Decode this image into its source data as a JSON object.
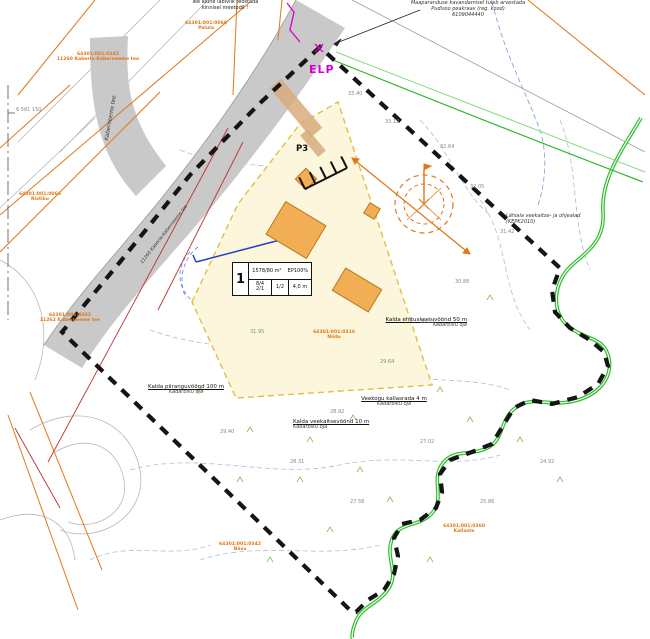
{
  "title": "Detailplaneeringu põhijoonis",
  "colors": {
    "boundary": "#151515",
    "road": "#c9c9c9",
    "plot_fill": "#fcf6dc",
    "plot_border": "#e0c040",
    "cadastral_orange": "#e07818",
    "building_fill": "#f2ae55",
    "river_green": "#2db82d",
    "water_blue": "#2244cc",
    "magenta": "#d400d4",
    "red_line": "#c03030",
    "contour_blue": "#a8c0dc"
  },
  "notes": {
    "crossing": {
      "line1": "Tee alune läbiviik teostada",
      "line2": "kinnisel meetodil !"
    },
    "drainage": {
      "line1": "Maaparanduse kavandamisel tuleb arvestada",
      "line2": "Pudisoo peakraav (reg. kood)",
      "line3": "6109044440"
    },
    "vicinity": {
      "line1": "Lähiala veekaitse- ja ohjealad",
      "line2": "(KEPK2010)"
    }
  },
  "zones": [
    {
      "title": "Kalda ehituskeeluvöönd 50 m",
      "sub": "Kadarbiku oja"
    },
    {
      "title": "Veekogu kallasrada 4 m",
      "sub": "Kadarbiku oja"
    },
    {
      "title": "Kalda veekaitsevöönd 10 m",
      "sub": "Kadarbiku oja"
    },
    {
      "title": "Kalda piiranguvöönd 100 m",
      "sub": "Kadarbiku oja"
    }
  ],
  "cadastral_labels": [
    {
      "code": "64301:001:0060",
      "name": "Palula"
    },
    {
      "code": "64301:001:0242",
      "name": "11260 Kaberla-Kaberneeme tee"
    },
    {
      "code": "64301:001:0362",
      "name": "11262 Kaberneeme tee"
    },
    {
      "code": "64301:001:0066",
      "name": "Ristiku"
    },
    {
      "code": "64301:001:0316",
      "name": "Niidu"
    },
    {
      "code": "64301:001:0360",
      "name": "Kallaste"
    },
    {
      "code": "64301:001:0342",
      "name": "Näsu"
    }
  ],
  "plot_table": {
    "number": "1",
    "area": "1578/80 m²",
    "use": "EP100%",
    "storeys": "8/4",
    "storeys2": "2/1",
    "ratio": "1/2",
    "height": "4,0 m"
  },
  "markers": {
    "elp": "ELP",
    "parking": "P3"
  },
  "road_names": {
    "branch": "Kaberneeme tee",
    "main": "11260 Kaberla-Kaberneeme tee"
  },
  "grid_label": "6 581 150",
  "elevations": [
    "33.40",
    "33.12",
    "32.64",
    "32.05",
    "31.42",
    "30.88",
    "30.25",
    "29.64",
    "28.92",
    "28.31",
    "27.58",
    "27.02",
    "31.95",
    "29.40",
    "25.86",
    "24.92"
  ]
}
